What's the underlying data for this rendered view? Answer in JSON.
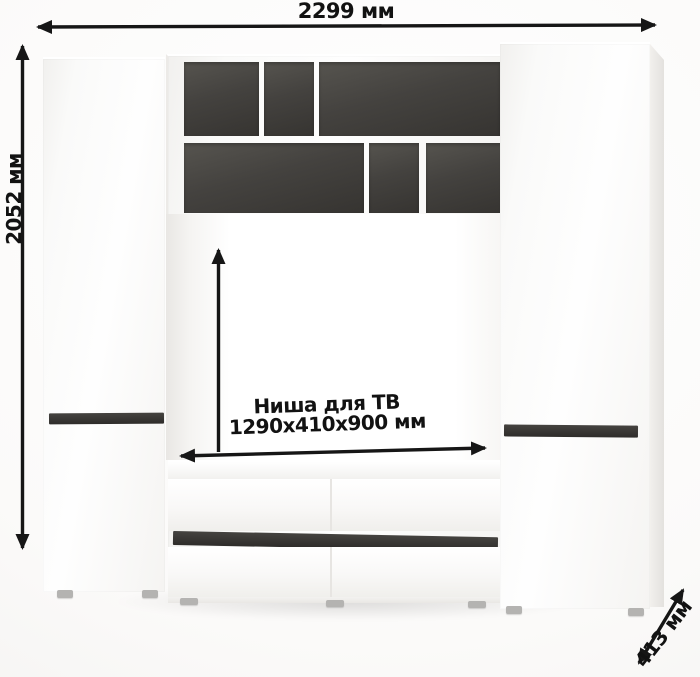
{
  "labels": {
    "width": "2299 мм",
    "height": "2052 мм",
    "depth": "413 мм",
    "niche_line1": "Ниша для ТВ",
    "niche_line2": "1290x410x900 мм"
  },
  "colors": {
    "arrow": "#161616",
    "furniture_white": "#fbfaf9",
    "open_shelf_interior": "#44423f",
    "handle_strip": "#454340",
    "feet": "#b4b3b1",
    "background": "#fbfaf9"
  }
}
